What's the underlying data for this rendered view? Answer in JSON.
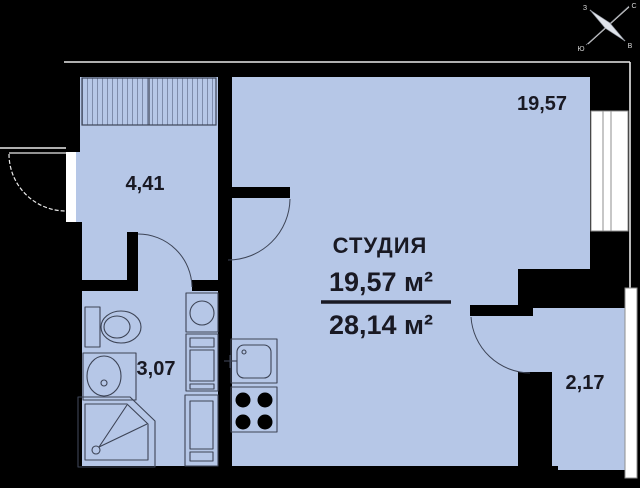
{
  "plan": {
    "title": "СТУДИЯ",
    "living_area": "19,57 м²",
    "total_area": "28,14 м²",
    "rooms": {
      "studio": {
        "label": "19,57"
      },
      "hall": {
        "label": "4,41"
      },
      "bathroom": {
        "label": "3,07"
      },
      "loggia": {
        "label": "2,17"
      }
    },
    "compass": {
      "north": "С",
      "south": "Ю",
      "east": "В",
      "west": "З"
    },
    "fixtures": [
      "wardrobe",
      "toilet-icon",
      "bath-sink-icon",
      "shower-icon",
      "washing-machine-icon",
      "cabinet-icon",
      "kitchen-sink-icon",
      "stove-icon",
      "window",
      "loggia-glazing",
      "entrance-door",
      "compass-icon"
    ]
  },
  "colors": {
    "floor": "#b6c7e7",
    "wall": "#000000",
    "fixture": "#3d4456",
    "hatch": "#7e8cab",
    "outline": "#e9e9e9",
    "glass": "#ffffff",
    "glassline": "#8f8f8f",
    "text": "#191923"
  }
}
